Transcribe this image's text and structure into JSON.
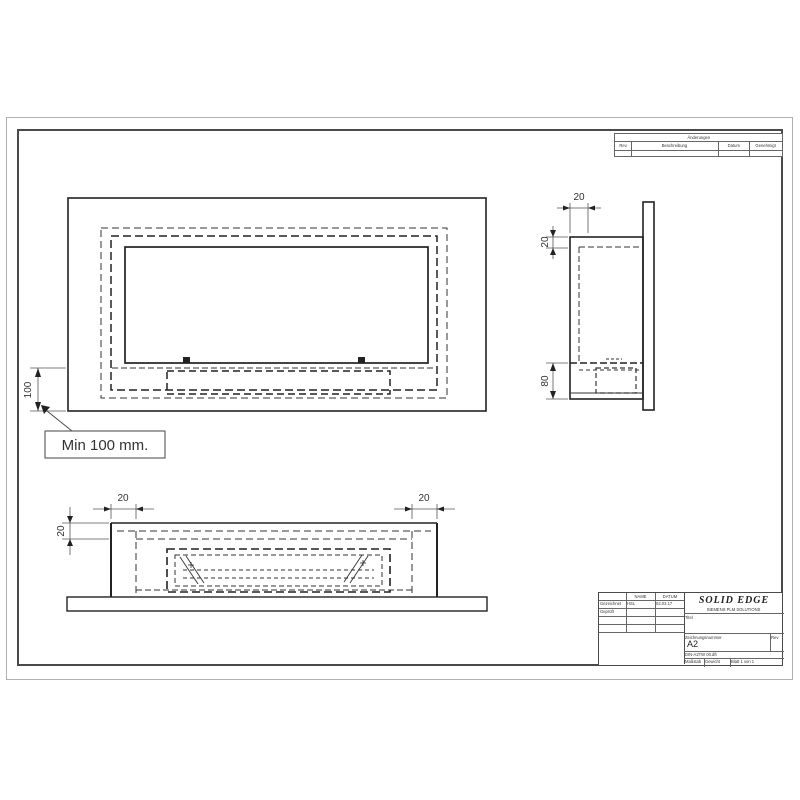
{
  "revision_table": {
    "title": "Änderungen",
    "col_rev": "Rev",
    "col_desc": "Beschreibung",
    "col_date": "Datum",
    "col_appr": "Genehmigt"
  },
  "title_block": {
    "name_header": "NAME",
    "date_header": "DATUM",
    "row1_label": "Gezeichnet",
    "row1_name": "HSL",
    "row1_date": "02.03.17",
    "row2_label": "Geprüft",
    "logo_title": "SOLID EDGE",
    "logo_subtitle": "SIEMENS PLM SOLUTIONS",
    "title_label": "Titel",
    "number_label": "Zeichnungsnummer",
    "sheet_size": "A2",
    "rev_label": "Rev",
    "filename": "DIN-A2TW 00.dft",
    "scale_label": "Maßstab",
    "weight_label": "Gewicht",
    "sheet_label": "Blatt 1 von 1"
  },
  "dimensions": {
    "front_min_height": "100",
    "callout_note": "Min 100 mm.",
    "side_depth": "20",
    "side_flange": "20",
    "side_bottom_height": "80",
    "plan_left_wall": "20",
    "plan_right_wall": "20",
    "plan_front_wall": "20"
  }
}
